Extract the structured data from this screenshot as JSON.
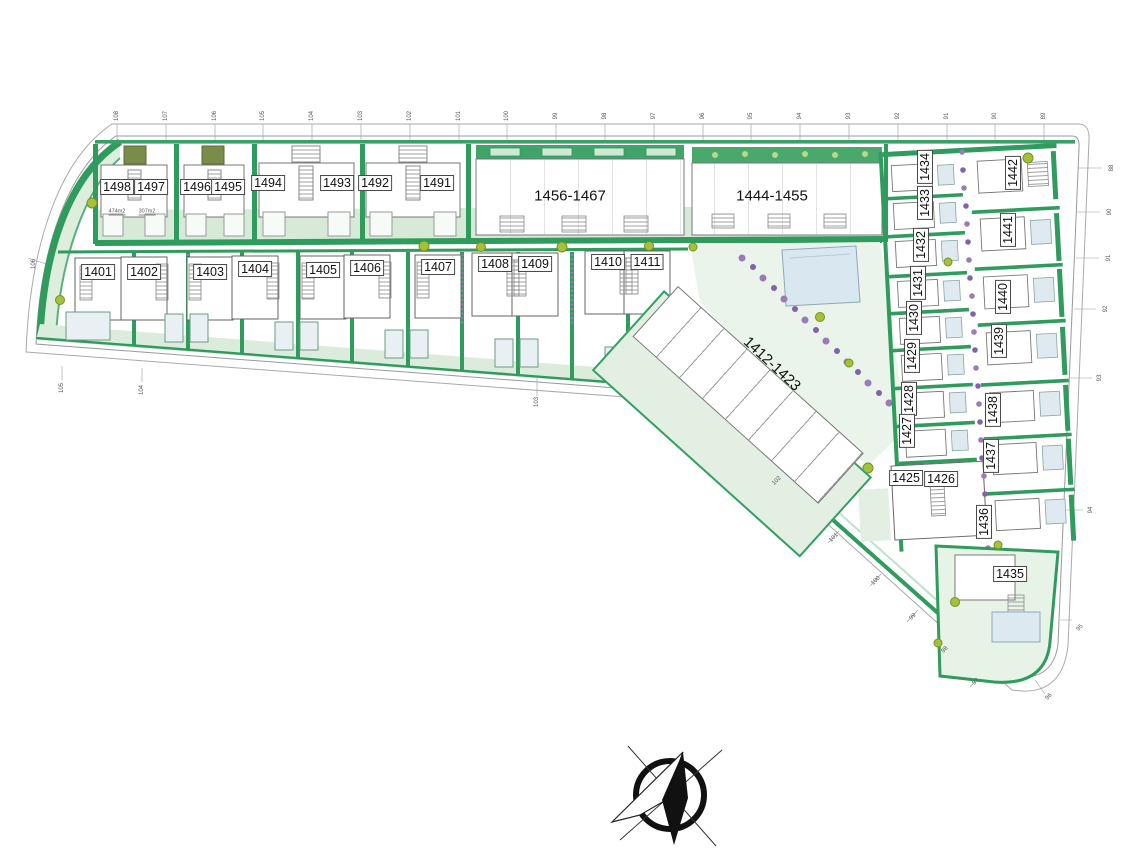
{
  "plots": {
    "1401": "1401",
    "1402": "1402",
    "1403": "1403",
    "1404": "1404",
    "1405": "1405",
    "1406": "1406",
    "1407": "1407",
    "1408": "1408",
    "1409": "1409",
    "1410": "1410",
    "1411": "1411",
    "1425": "1425",
    "1426": "1426",
    "1427": "1427",
    "1428": "1428",
    "1429": "1429",
    "1430": "1430",
    "1431": "1431",
    "1432": "1432",
    "1433": "1433",
    "1434": "1434",
    "1435": "1435",
    "1436": "1436",
    "1437": "1437",
    "1438": "1438",
    "1439": "1439",
    "1440": "1440",
    "1441": "1441",
    "1442": "1442",
    "1491": "1491",
    "1492": "1492",
    "1493": "1493",
    "1494": "1494",
    "1495": "1495",
    "1496": "1496",
    "1497": "1497",
    "1498": "1498"
  },
  "blocks": {
    "block_a": "1456-1467",
    "block_b": "1444-1455",
    "block_c": "1412-1423"
  },
  "areas": {
    "left": "474m2",
    "right": "307m2"
  },
  "stations": {
    "top": [
      "108",
      "107",
      "106",
      "105",
      "104",
      "103",
      "102",
      "101",
      "100",
      "99",
      "98",
      "97",
      "96",
      "95",
      "94",
      "93",
      "92",
      "91",
      "90",
      "89"
    ],
    "right": [
      "88",
      "90",
      "91",
      "92",
      "93",
      "94",
      "95",
      "96"
    ],
    "diag": [
      "102",
      "101",
      "100",
      "99",
      "98",
      "97"
    ],
    "bottom": [
      "105",
      "104",
      "103"
    ],
    "left": [
      "106"
    ]
  },
  "colors": {
    "hedge_green": "#2f9b5d",
    "lawn_green": "#ddeedd",
    "pool_blue": "#dbe8f0",
    "shrub_purple": "#9b7ab8",
    "tree_green": "#a5c13c",
    "outline_gray": "#888"
  },
  "compass": {
    "label": "north-arrow"
  }
}
